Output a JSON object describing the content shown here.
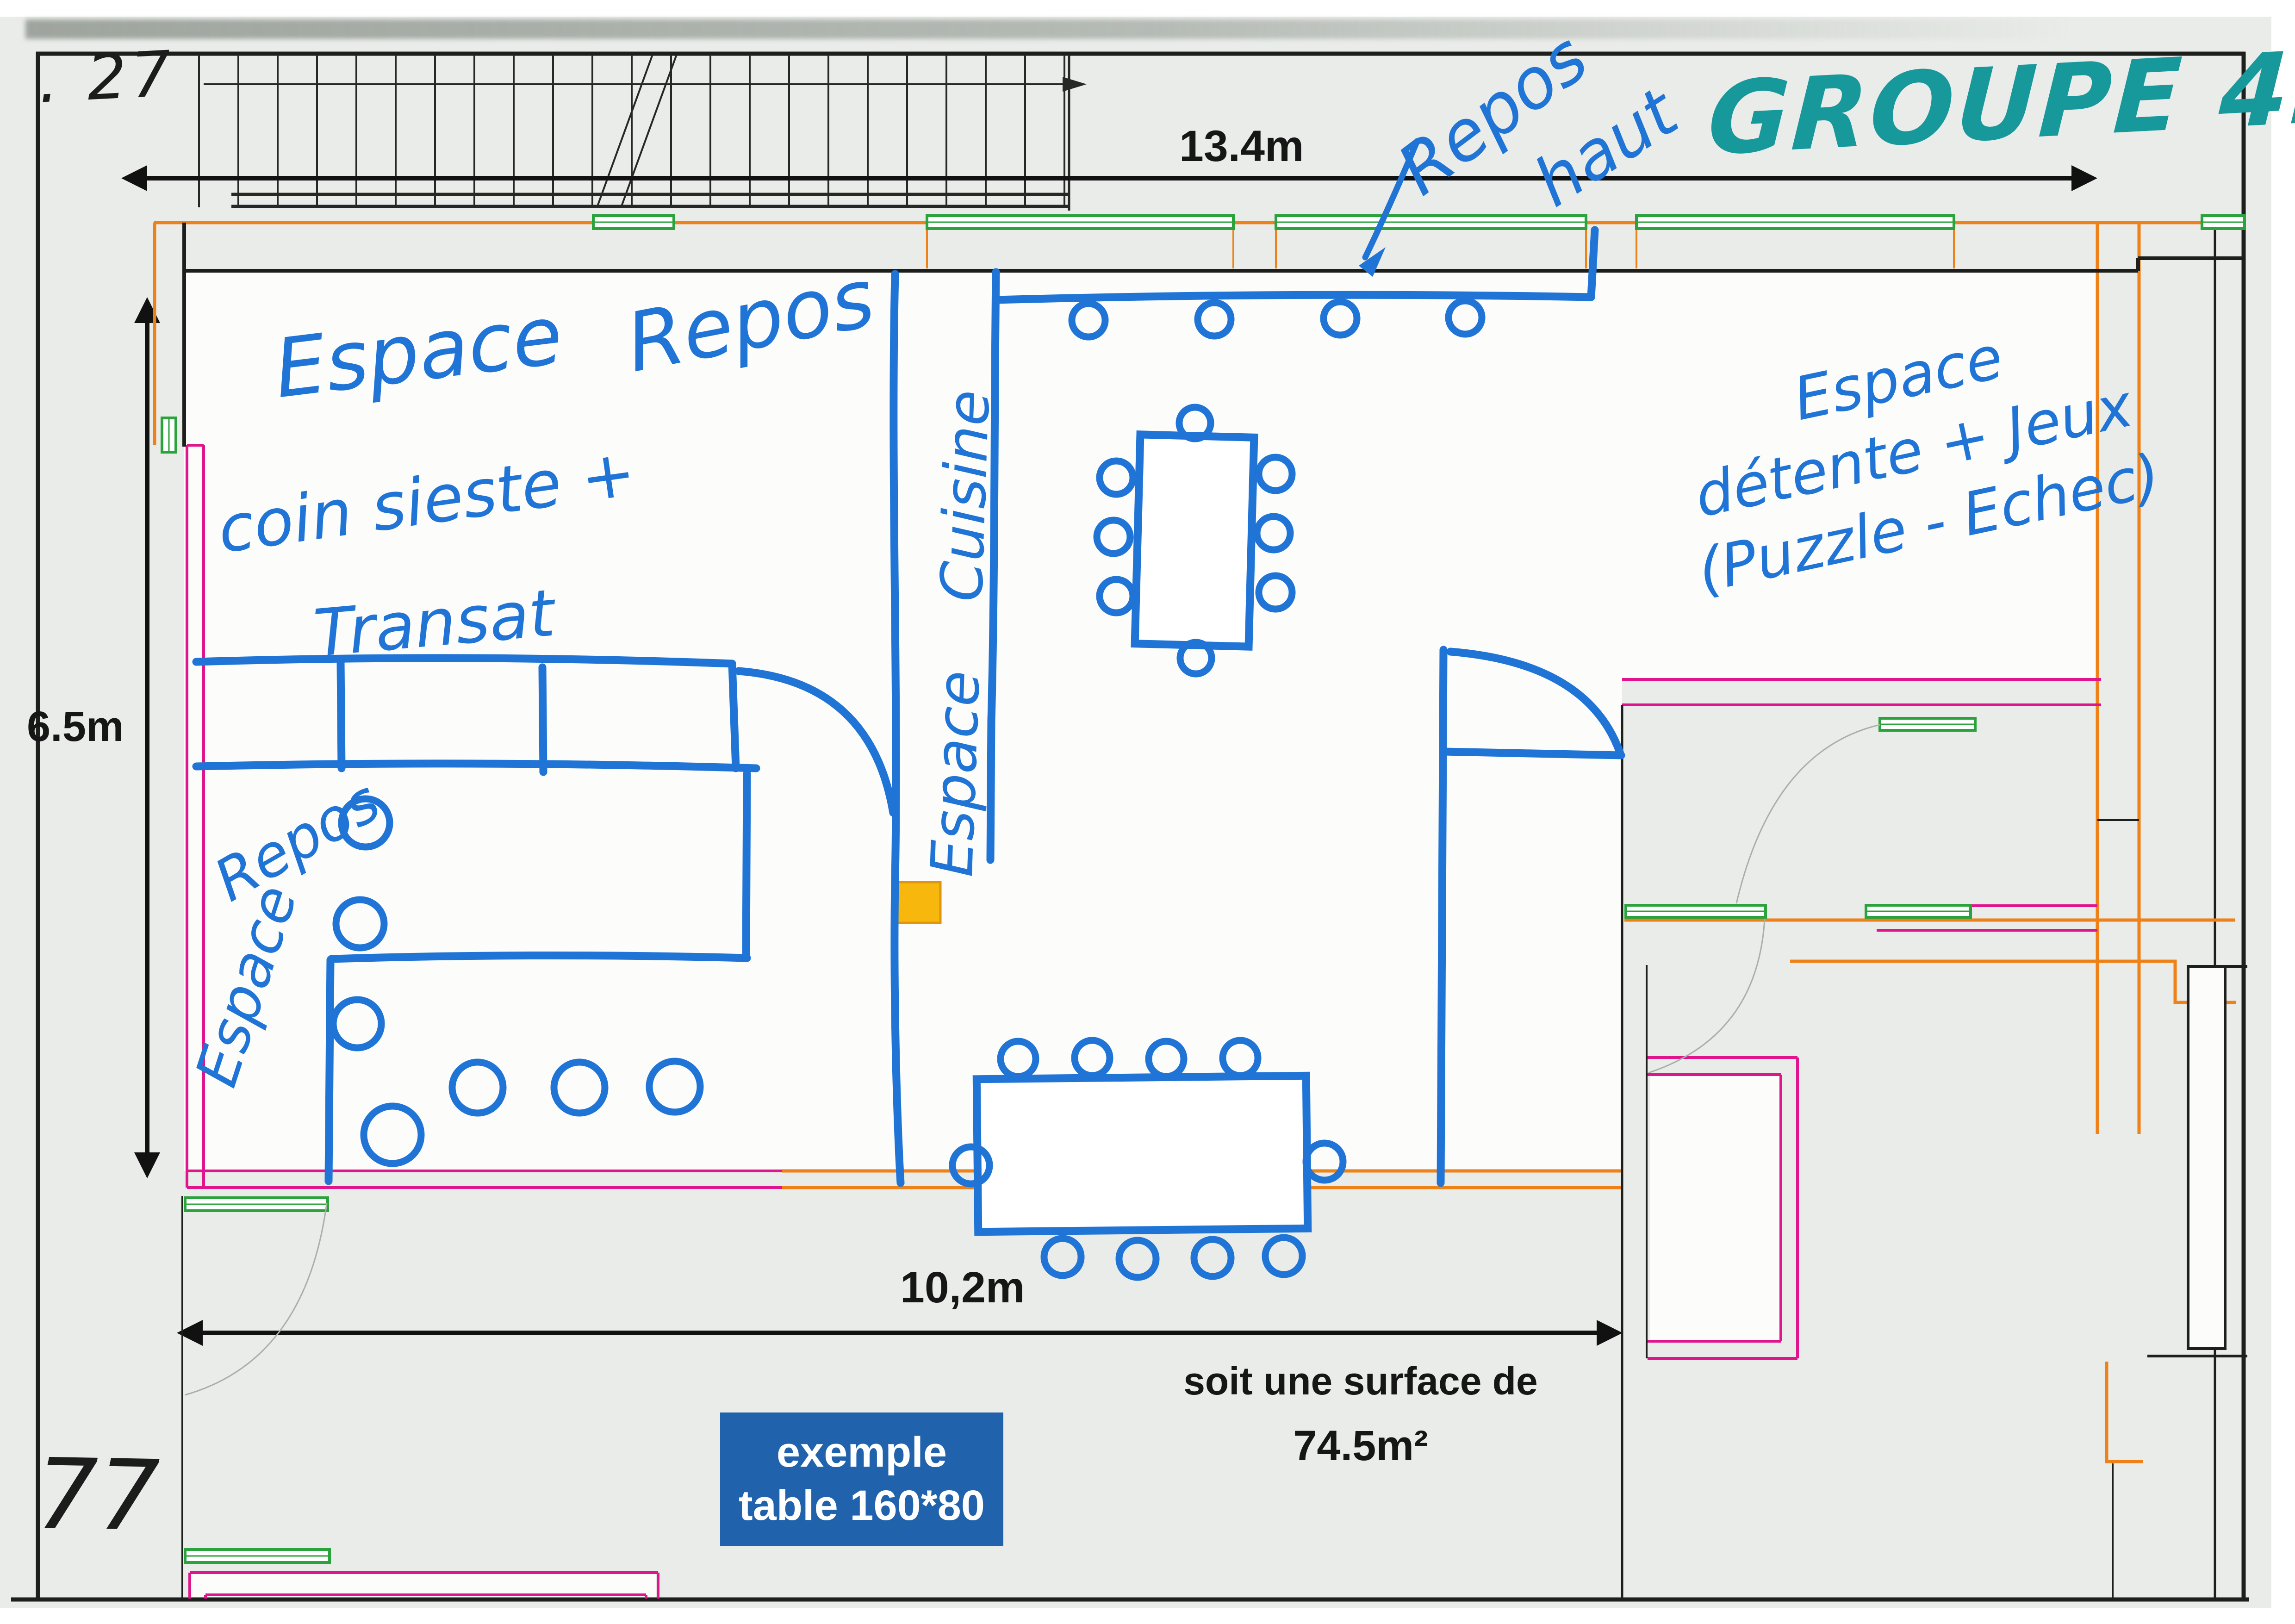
{
  "document": {
    "corner_note": ". 27",
    "sheet_number": "77"
  },
  "dimensions": {
    "top_width": "13.4m",
    "left_height": "6.5m",
    "bottom_width": "10,2m",
    "surface_label": "soit une surface de",
    "surface_value": "74.5m²"
  },
  "legend_box": {
    "line1": "exemple",
    "line2": "table 160*80"
  },
  "annotations": {
    "group_label": "GROUPE 4B",
    "repos_haut_word1": "Repos",
    "repos_haut_word2": "haut",
    "espace_repos_title_word1": "Espace",
    "espace_repos_title_word2": "Repos",
    "espace_repos_line2": "coin sieste +",
    "espace_repos_line3": "Transat",
    "espace_repos_wall_word1": "Espace",
    "espace_repos_wall_word2": "Repos",
    "cuisine_word1": "Espace",
    "cuisine_word2": "Cuisine",
    "detente_line1": "Espace",
    "detente_line2": "détente + Jeux",
    "detente_line3": "(Puzzle - Echec)"
  },
  "colors": {
    "marker_blue": "#1f74d6",
    "teal": "#17989b",
    "magenta": "#e0148c",
    "orange": "#ee8117",
    "green": "#2ba33c",
    "yellow_square": "#f7b70c",
    "legend_bg": "#2063ac"
  }
}
